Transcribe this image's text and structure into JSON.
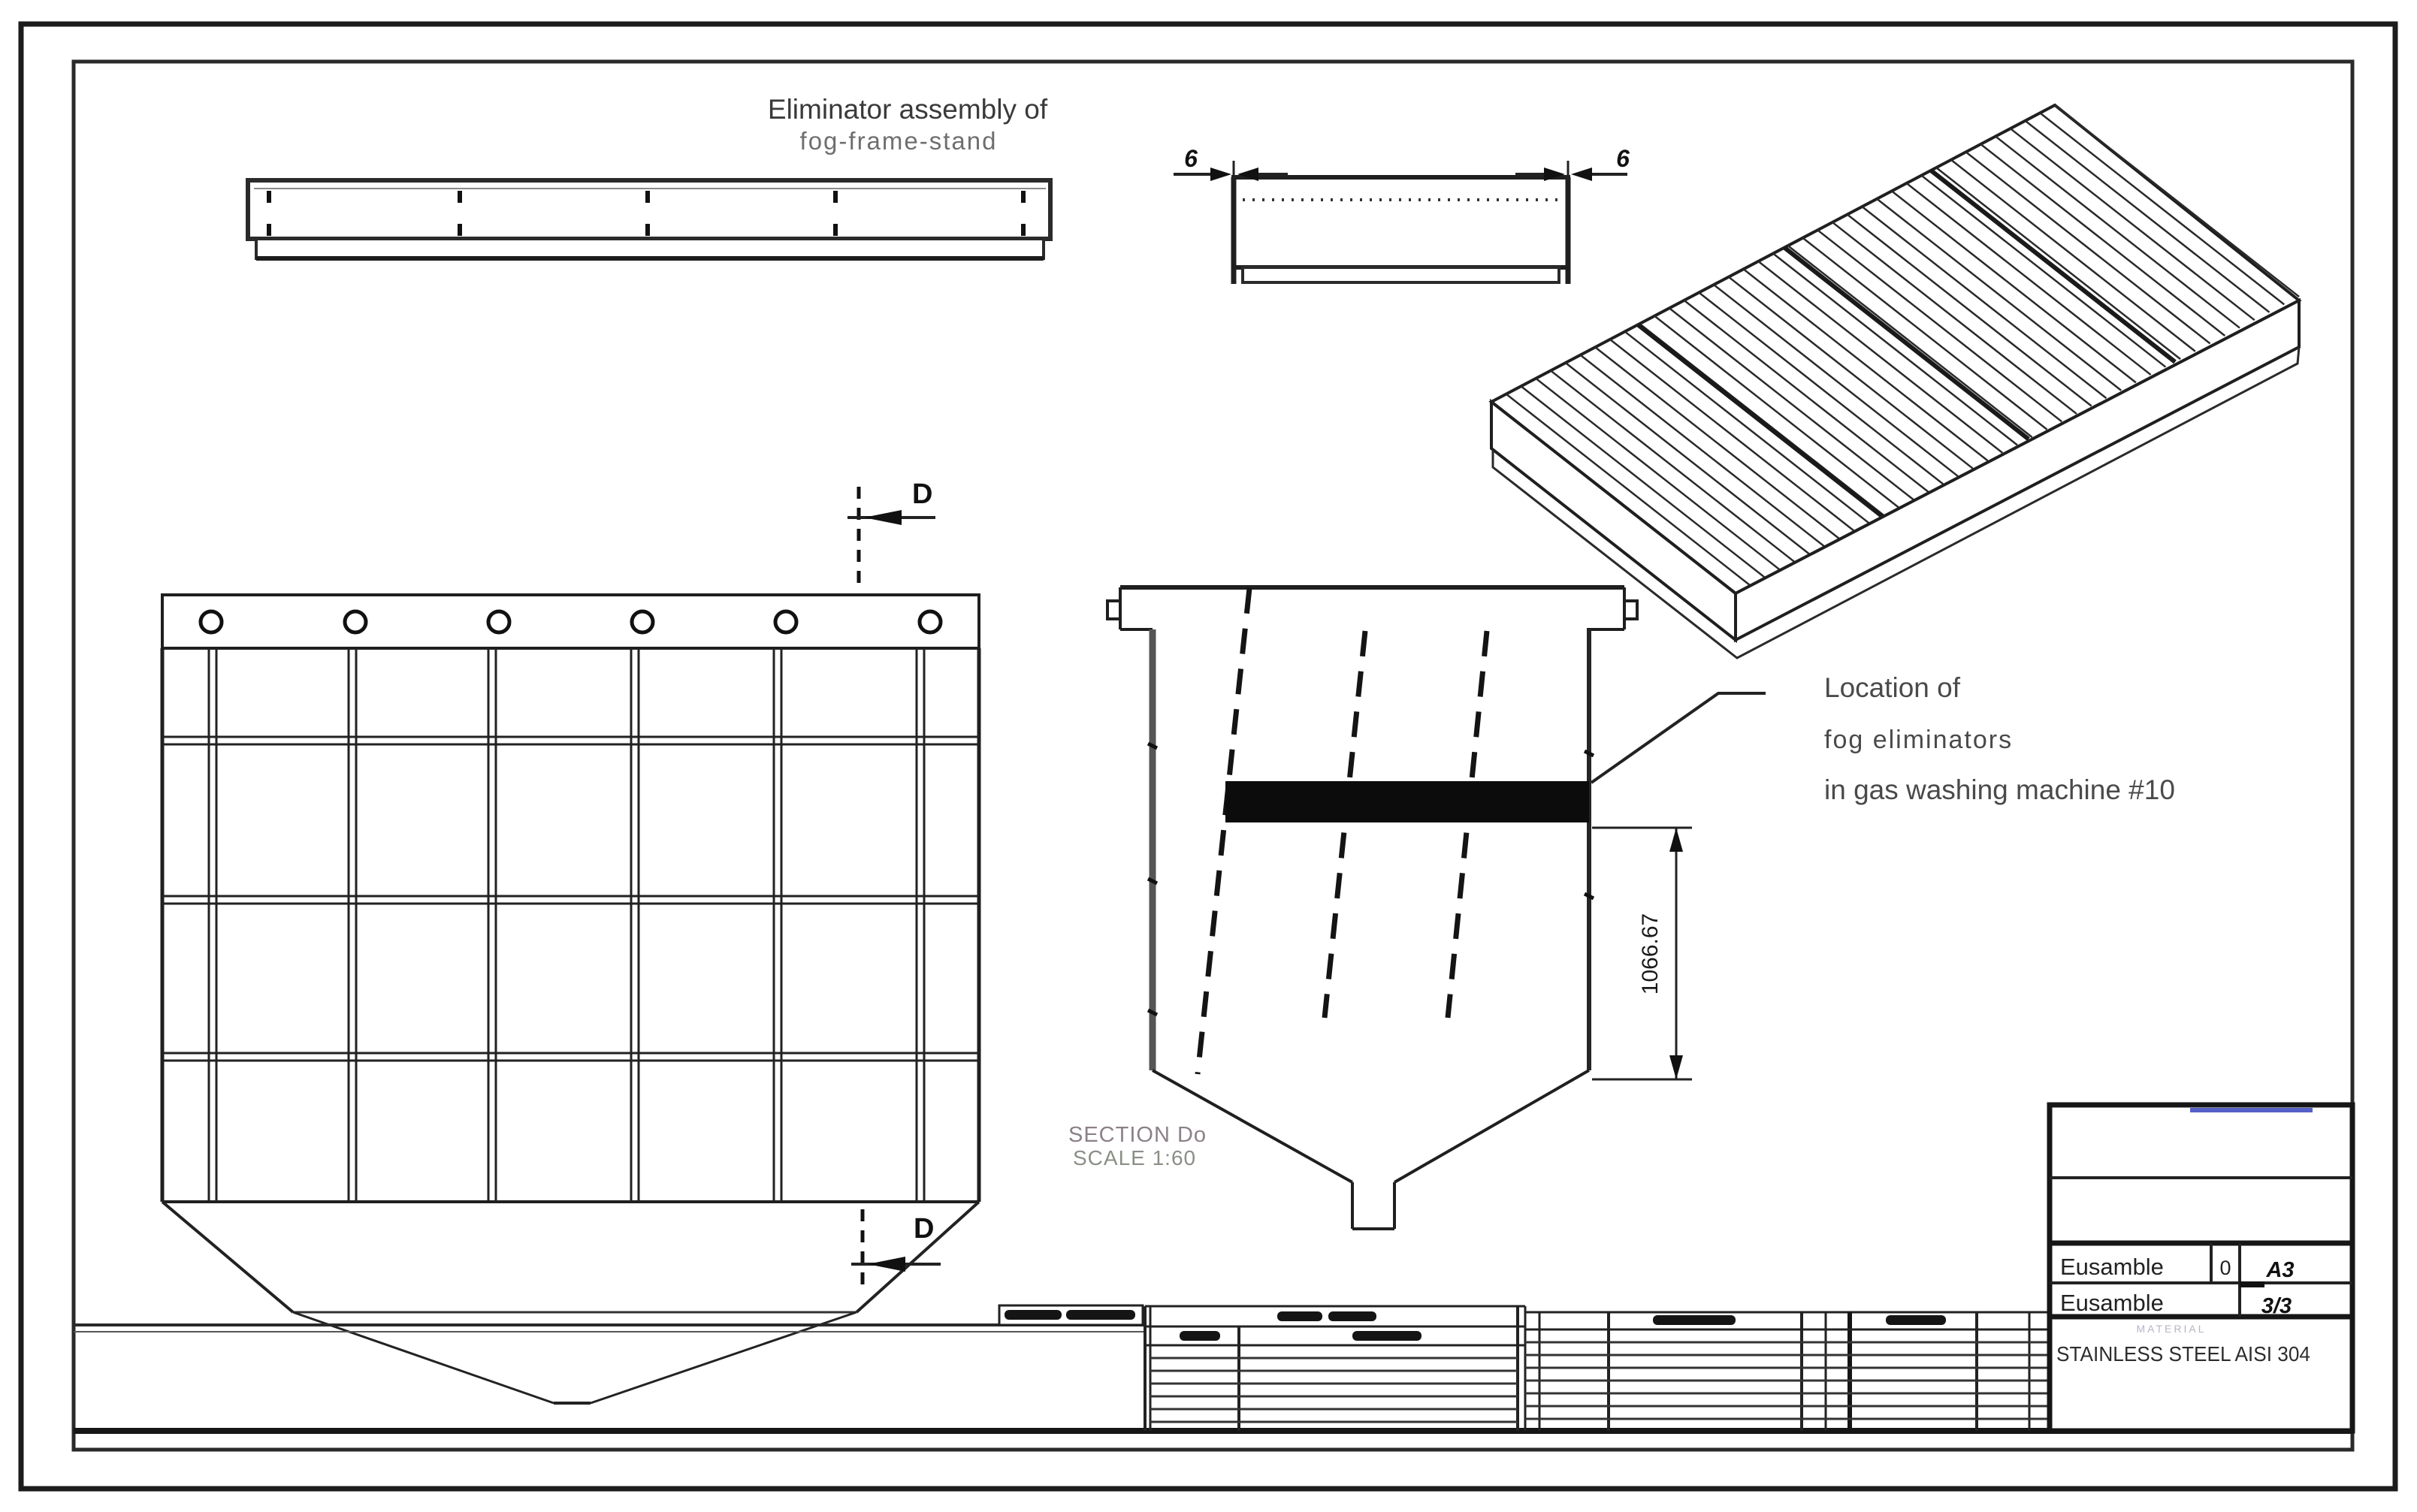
{
  "sheet": {
    "title_line1": "Eliminator assembly of",
    "title_line2": "fog-frame-stand",
    "annotation": {
      "line1": "Location of",
      "line2": "fog eliminators",
      "line3": "in gas washing machine #10"
    },
    "section_label": {
      "line1": "SECTION Do",
      "line2": "SCALE 1:60"
    },
    "dimensions": {
      "thickness_left": "6",
      "thickness_right": "6",
      "height": "1066.67",
      "section_mark_top": "D",
      "section_mark_bottom": "D"
    },
    "title_block": {
      "row1": {
        "name": "Eusamble",
        "revision": "0",
        "size": "A3"
      },
      "row2": {
        "name": "Eusamble",
        "sheet": "3/3"
      },
      "material_label": "MATERIAL",
      "material_value": "STAINLESS STEEL AISI 304"
    },
    "colors": {
      "line": "#1f1f1f",
      "accent_blue": "#5560c8",
      "muted": "#6f6f6f",
      "section_text": "#8b8089"
    }
  }
}
